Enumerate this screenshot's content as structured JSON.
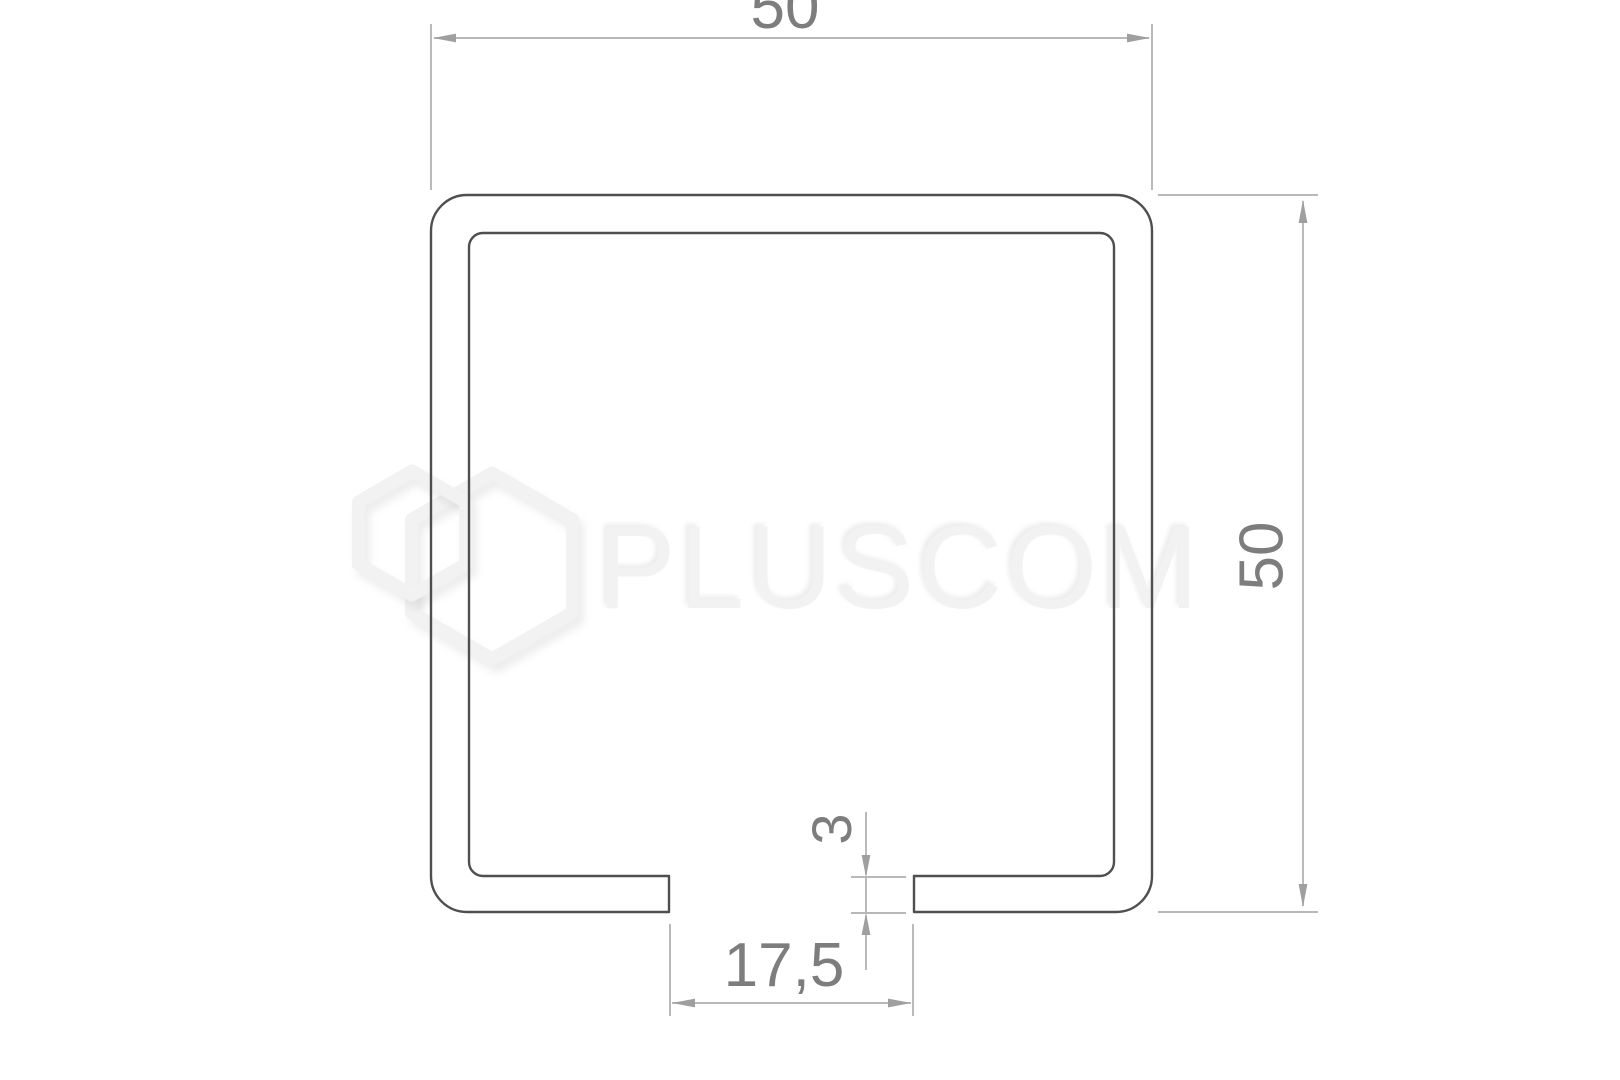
{
  "diagram": {
    "type": "technical-drawing",
    "subject": "C-channel sliding-gate track profile cross-section",
    "dimension_labels": {
      "top_width": "50",
      "right_height": "50",
      "bottom_gap": "17,5",
      "lip_thickness": "3"
    },
    "measurements": {
      "outer_width": 50,
      "outer_height": 50,
      "bottom_opening": 17.5,
      "lip_thickness": 3
    }
  },
  "watermark": {
    "brand": "PLUSCOM",
    "logo_icon": "double-hexagon"
  },
  "colors": {
    "background": "#ffffff",
    "outline": "#4f4f4f",
    "dimension": "#aeaeae",
    "arrow": "#9f9f9f",
    "dimension_text": "#7d7d7d",
    "watermark": "#f2f2f2"
  }
}
